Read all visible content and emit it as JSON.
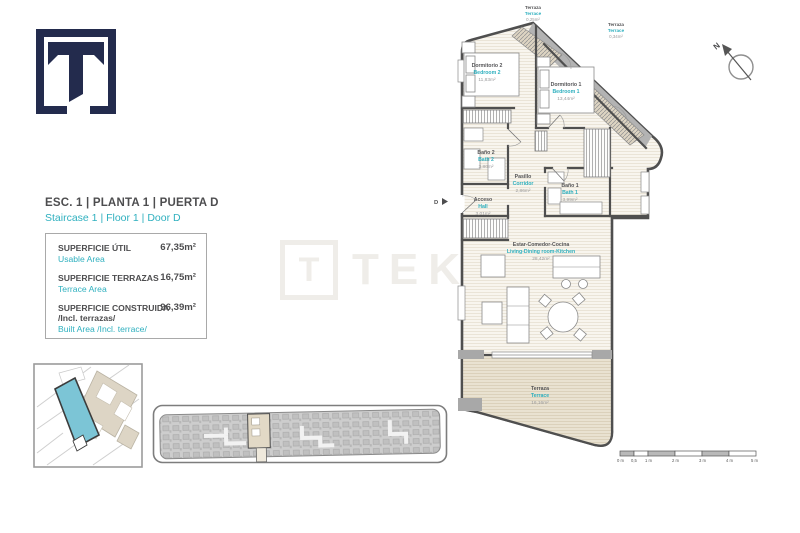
{
  "logo": {
    "letter": "T",
    "color": "#232b4d"
  },
  "header": {
    "title_es": "ESC. 1 | PLANTA 1 | PUERTA D",
    "title_en": "Staircase 1 | Floor 1 | Door D"
  },
  "areas": {
    "rows": [
      {
        "label_es": "SUPERFICIE ÚTIL",
        "label_en": "Usable Area",
        "value": "67,35m²"
      },
      {
        "label_es": "SUPERFICIE TERRAZAS",
        "label_en": "Terrace Area",
        "value": "16,75m²"
      },
      {
        "label_es": "SUPERFICIE CONSTRUIDA",
        "label_es2": "/Incl. terrazas/",
        "label_en": "Built Area /Incl. terrace/",
        "value": "96,39m²"
      }
    ]
  },
  "floorplan": {
    "rooms": [
      {
        "name_es": "Dormitorio 2",
        "name_en": "Bedroom 2",
        "area": "11,83m²"
      },
      {
        "name_es": "Dormitorio 1",
        "name_en": "Bedroom 1",
        "area": "13,44m²"
      },
      {
        "name_es": "Baño 2",
        "name_en": "Bath 2",
        "area": "3,80m²"
      },
      {
        "name_es": "Pasillo",
        "name_en": "Corridor",
        "area": "2,86m²"
      },
      {
        "name_es": "Baño 1",
        "name_en": "Bath 1",
        "area": "3,99m²"
      },
      {
        "name_es": "Acceso",
        "name_en": "Hall",
        "area": "3,01m²"
      },
      {
        "name_es": "Estar-Comedor-Cocina",
        "name_en": "Living-Dining room-Kitchen",
        "area": "28,42m²"
      },
      {
        "name_es": "Terraza",
        "name_en": "Terrace",
        "area": "16,16m²"
      },
      {
        "name_es": "Terraza",
        "name_en": "Terrace",
        "area": "0,25m²"
      },
      {
        "name_es": "Terraza",
        "name_en": "Terrace",
        "area": "0,34m²"
      }
    ],
    "door_marker": "D",
    "compass_label": "N",
    "scalebar": {
      "labels": [
        "0 m",
        "0,5",
        "1 m",
        "2 m",
        "3 m",
        "4 m",
        "5 m"
      ]
    }
  },
  "watermark": {
    "text": "TEKCE",
    "logo_letter": "T"
  },
  "colors": {
    "accent_teal": "#2fb0bf",
    "text_dark": "#4d4d4f",
    "text_gray": "#9a9a9c",
    "navy": "#232b4d",
    "wall": "#4f4f4f",
    "floor": "#f8f5ee",
    "terrace": "#e9e2d2",
    "site_highlight": "#7cc5d6"
  }
}
